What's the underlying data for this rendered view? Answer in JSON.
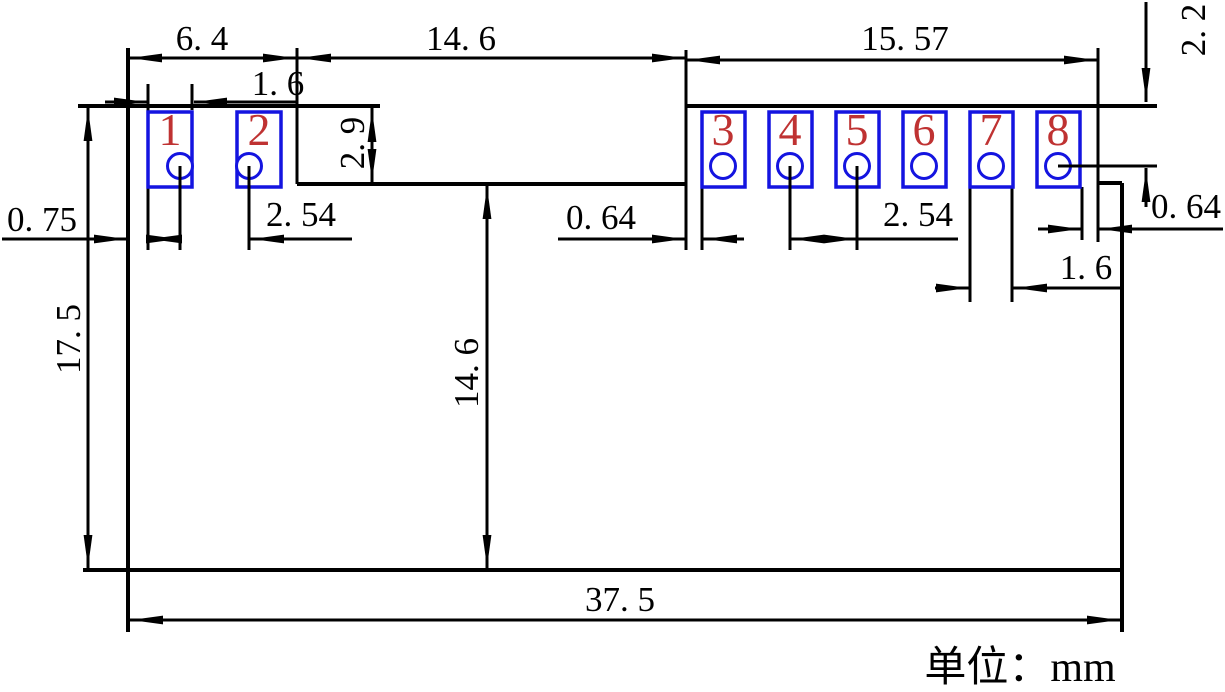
{
  "drawing": {
    "kind": "pcb-module-footprint-dimension-drawing",
    "unit_note": {
      "text": "单位：mm",
      "label": "单位",
      "unit": "mm"
    },
    "colors": {
      "line": "#000000",
      "pad_outline": "#1414e0",
      "pad_number": "#bf3232",
      "background": "#ffffff"
    },
    "pads": {
      "count": 8,
      "numbers": [
        "1",
        "2",
        "3",
        "4",
        "5",
        "6",
        "7",
        "8"
      ]
    },
    "dims": {
      "w64": {
        "text": "6. 4",
        "mm": 6.4
      },
      "w146_top": {
        "text": "14. 6",
        "mm": 14.6
      },
      "w1557": {
        "text": "15. 57",
        "mm": 15.57
      },
      "h22": {
        "text": "2. 2",
        "mm": 2.2
      },
      "w16_pad1": {
        "text": "1. 6",
        "mm": 1.6
      },
      "h29": {
        "text": "2. 9",
        "mm": 2.9
      },
      "w075": {
        "text": "0. 75",
        "mm": 0.75
      },
      "w254_left": {
        "text": "2. 54",
        "mm": 2.54
      },
      "w064_left": {
        "text": "0. 64",
        "mm": 0.64
      },
      "w254_mid": {
        "text": "2. 54",
        "mm": 2.54
      },
      "w064_right": {
        "text": "0. 64",
        "mm": 0.64
      },
      "w16_pad7": {
        "text": "1. 6",
        "mm": 1.6
      },
      "h175": {
        "text": "17. 5",
        "mm": 17.5
      },
      "h146_mid": {
        "text": "14. 6",
        "mm": 14.6
      },
      "w375": {
        "text": "37. 5",
        "mm": 37.5
      }
    }
  }
}
